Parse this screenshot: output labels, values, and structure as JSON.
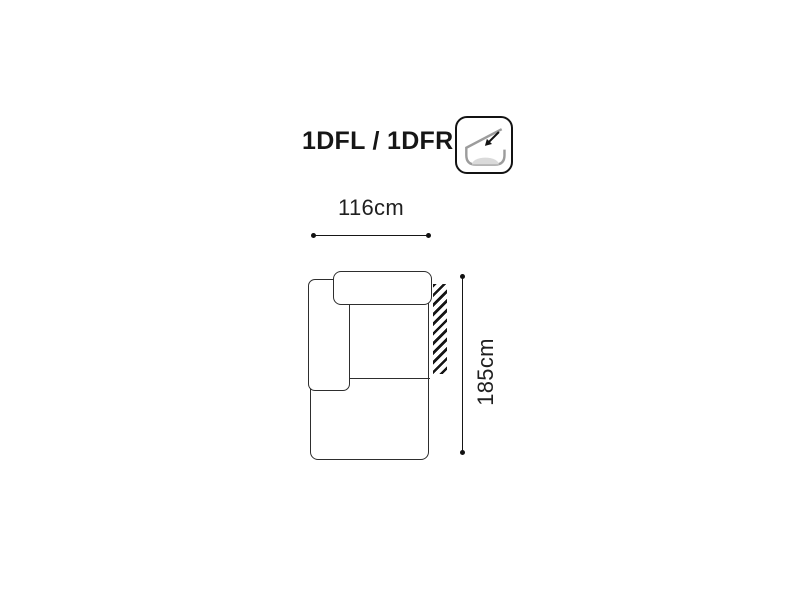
{
  "title": "1DFL / 1DFR",
  "feature_icon": "reclining-backrest-icon",
  "dimensions": {
    "width_label": "116cm",
    "height_label": "185cm"
  },
  "colors": {
    "background": "#ffffff",
    "text": "#161616",
    "sofa_outline": "#2e2e2e",
    "dimension_line": "#161616",
    "hatch_stripe": "#161616",
    "icon_profile_gray": "#9c9c9c",
    "icon_cushion_gray": "#dadada"
  }
}
